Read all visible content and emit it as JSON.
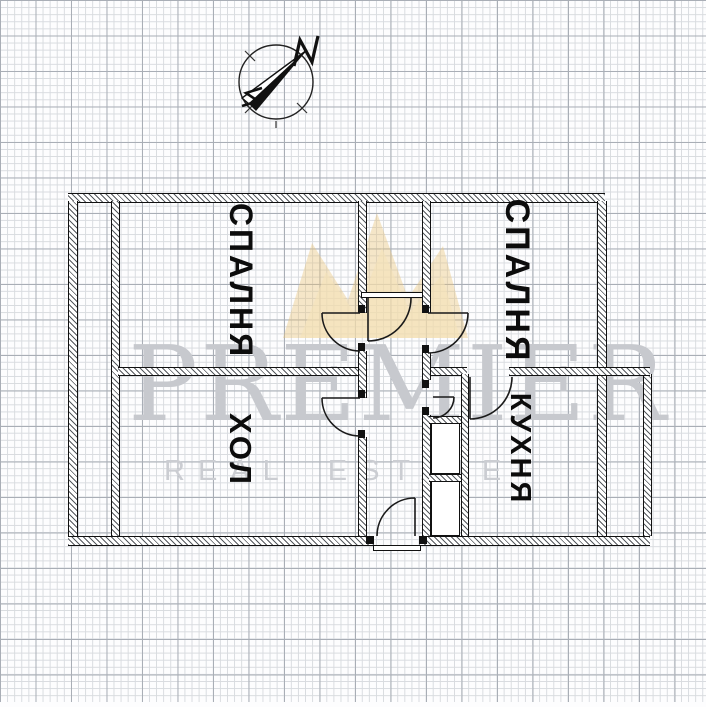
{
  "compass": {
    "label": "N"
  },
  "rooms": [
    {
      "id": "bedroom-left",
      "label": "СПАЛНЯ"
    },
    {
      "id": "bedroom-right",
      "label": "СПАЛНЯ"
    },
    {
      "id": "hall",
      "label": "ХОЛ"
    },
    {
      "id": "kitchen",
      "label": "КУХНЯ"
    }
  ],
  "watermark": {
    "brand": "PREMIER",
    "subtitle": "REAL ESTATE",
    "crown_color": "#e9c478",
    "crown_light_color": "#f5e3b9",
    "text_color": "#c7c9ce"
  },
  "plan_colors": {
    "wall_line": "#111111",
    "grid_minor": "#d8dbdf",
    "grid_major": "#a9aeb6",
    "paper": "#fdfdfe"
  }
}
